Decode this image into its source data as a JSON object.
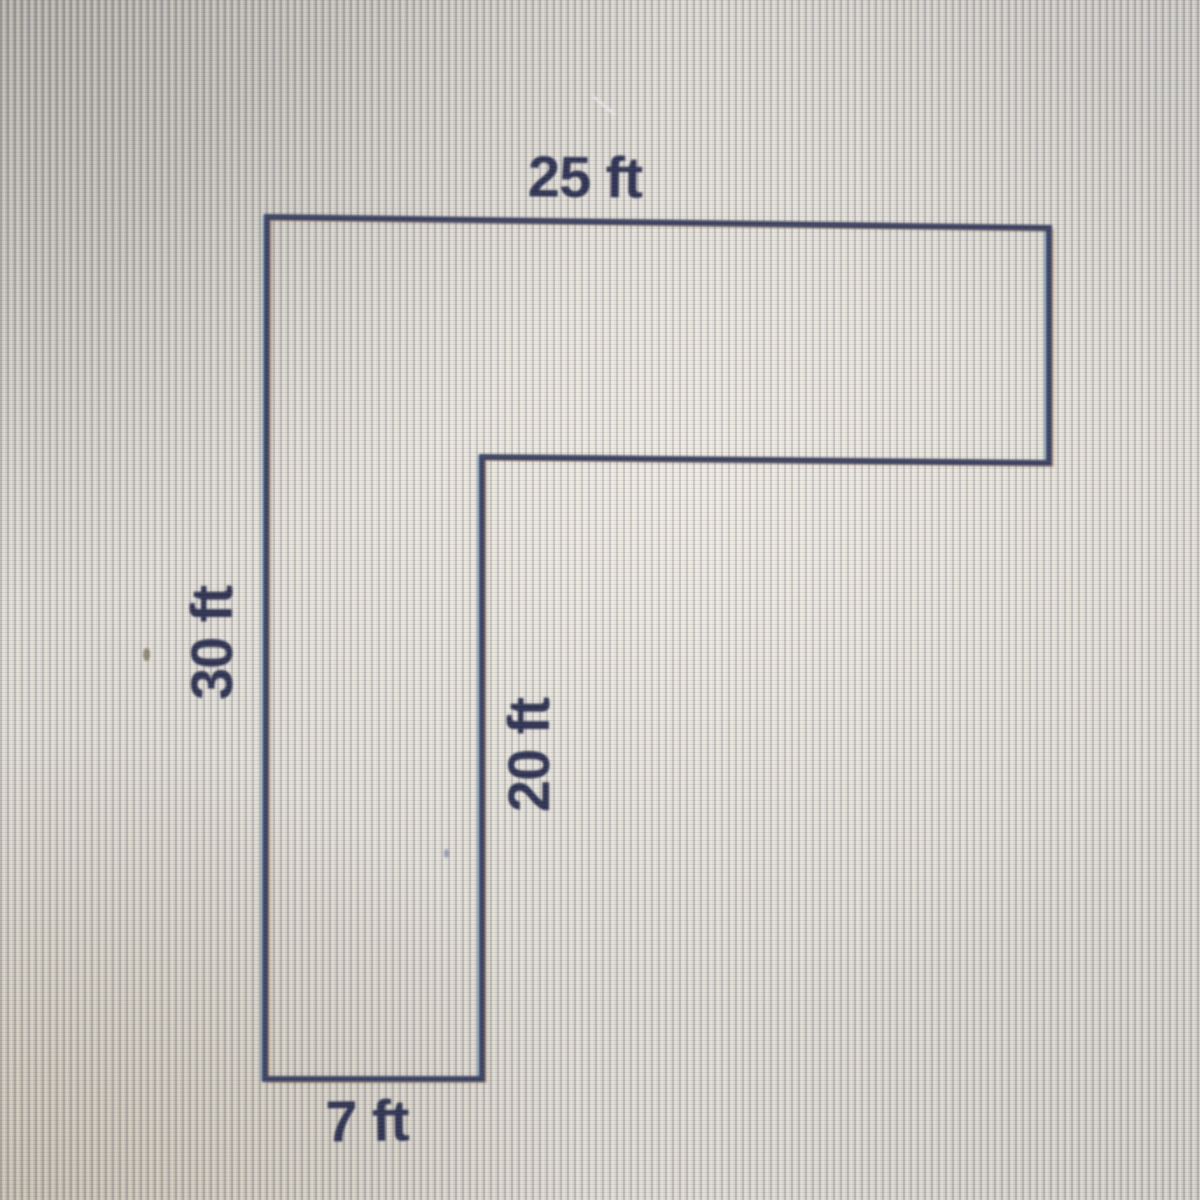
{
  "figure": {
    "kind": "L-shaped composite figure",
    "unit": "ft",
    "labels": {
      "top": "25 ft",
      "left": "30 ft",
      "inner": "20 ft",
      "bottom": "7 ft"
    },
    "sides": [
      {
        "position": "top",
        "value": 25,
        "unit": "ft"
      },
      {
        "position": "left",
        "value": 30,
        "unit": "ft"
      },
      {
        "position": "inner-vertical",
        "value": 20,
        "unit": "ft"
      },
      {
        "position": "bottom",
        "value": 7,
        "unit": "ft"
      }
    ],
    "colors": {
      "outline": "#3a4060",
      "label_text": "#2e3252",
      "screen_base": "#d5d2cb"
    }
  }
}
